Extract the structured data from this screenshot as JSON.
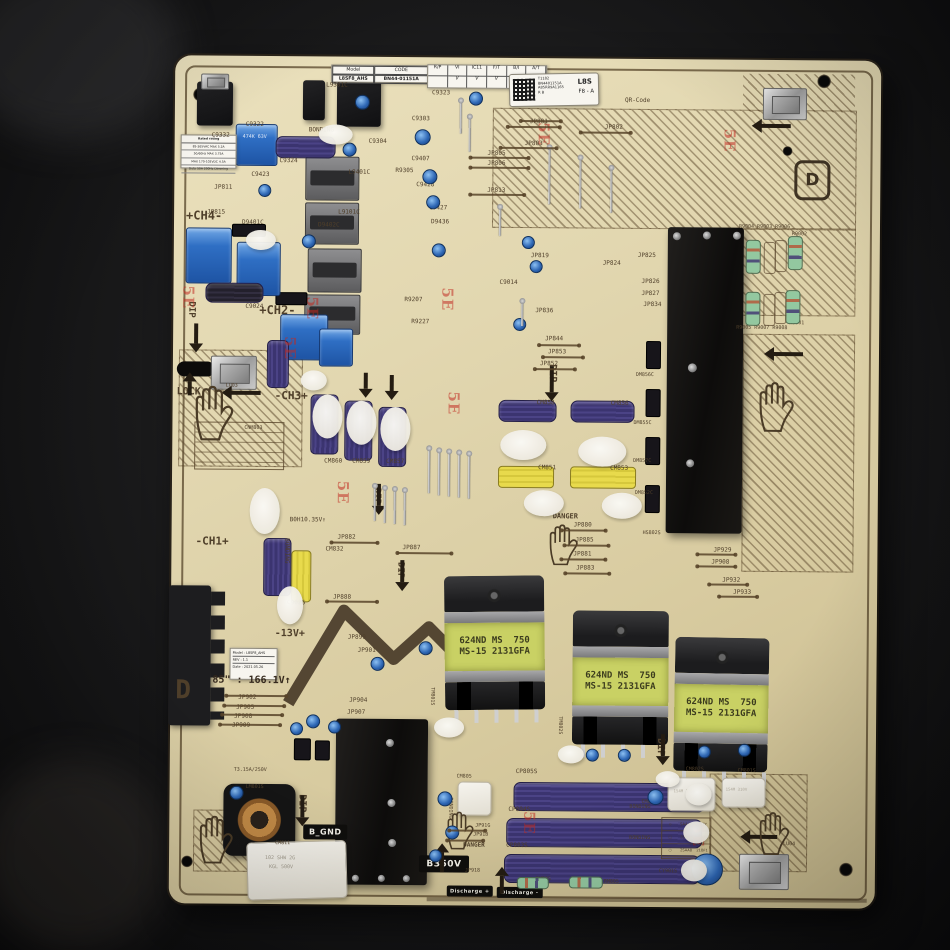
{
  "title": "Samsung power supply board photo",
  "stickers": {
    "model_label": {
      "model_key": "Model",
      "model_value": "L8SF8_AHS",
      "code_key": "CODE",
      "code_value": "BN44-01151A"
    },
    "check_strip": {
      "headers": [
        "R/P",
        "VI",
        "IC11",
        "F/T",
        "B/I",
        "A/T"
      ],
      "checks": [
        "",
        "V",
        "V",
        "V",
        "V",
        "V"
      ]
    },
    "barcode": {
      "line1": "T1182",
      "line2": "BN4401151A",
      "line3": "A85RR9A1165",
      "line4": "R B",
      "big": "L8S",
      "sub": "F8 - A"
    },
    "rev_label": {
      "model": "Model : L8SF8_AHS",
      "rev": "REV : 1.1",
      "date": "Date : 2021.05.26"
    },
    "rating_label": {
      "title": "Rated rating",
      "rows": [
        "85-265VAC  MAX 5.2A",
        "50/60Hz  MAX 3.75A",
        "MAX 170-102VDC 4.5A",
        "Duty 50A 200Hz  Dimming"
      ]
    },
    "legend_table": {
      "rows": [
        [
          "◇",
          "SAAA8",
          "21TY"
        ],
        [
          "□",
          "2SAA8",
          "21ATB"
        ],
        [
          "○",
          "2SAA8",
          "21BF1"
        ]
      ]
    }
  },
  "transformer_label": {
    "line1": "624ND MS  750",
    "line2": "MS-15 2131GFA"
  },
  "badges": {
    "b_gnd": "B_GND",
    "b350v": "B350V",
    "discharge_plus": "Discharge +",
    "discharge_minus": "Discharge -"
  },
  "marks": {
    "letter_d": "D"
  },
  "labels": [
    {
      "t": "C9322",
      "x": 243,
      "y": 124,
      "s": 6
    },
    {
      "t": "C9332",
      "x": 209,
      "y": 135,
      "s": 6
    },
    {
      "t": "BONDING",
      "x": 306,
      "y": 129,
      "s": 6
    },
    {
      "t": "C9323",
      "x": 429,
      "y": 91,
      "s": 6
    },
    {
      "t": "C9303",
      "x": 409,
      "y": 117,
      "s": 6
    },
    {
      "t": "L9301C",
      "x": 323,
      "y": 84,
      "s": 6
    },
    {
      "t": "C9304",
      "x": 366,
      "y": 140,
      "s": 6
    },
    {
      "t": "C9407",
      "x": 409,
      "y": 157,
      "s": 6
    },
    {
      "t": "R9305",
      "x": 393,
      "y": 169,
      "s": 6
    },
    {
      "t": "C9428",
      "x": 414,
      "y": 183,
      "s": 6
    },
    {
      "t": "C9427",
      "x": 427,
      "y": 206,
      "s": 6
    },
    {
      "t": "D9436",
      "x": 429,
      "y": 220,
      "s": 6
    },
    {
      "t": "C9423",
      "x": 249,
      "y": 174,
      "s": 6
    },
    {
      "t": "JP811",
      "x": 212,
      "y": 187,
      "s": 6
    },
    {
      "t": "JP815",
      "x": 205,
      "y": 212,
      "s": 6
    },
    {
      "t": "C9324",
      "x": 277,
      "y": 160,
      "s": 6
    },
    {
      "t": "D9401C",
      "x": 240,
      "y": 222,
      "s": 6
    },
    {
      "t": "L9401C",
      "x": 346,
      "y": 171,
      "s": 6
    },
    {
      "t": "L9101C",
      "x": 336,
      "y": 211,
      "s": 6
    },
    {
      "t": "474K 63V",
      "x": 240,
      "y": 137,
      "s": 5,
      "c": "#dfe9f8"
    },
    {
      "t": "+CH4-",
      "x": 184,
      "y": 212,
      "s": 12,
      "b": 1
    },
    {
      "t": "C9024",
      "x": 244,
      "y": 306,
      "s": 6
    },
    {
      "t": "+CH2-",
      "x": 258,
      "y": 306,
      "s": 12,
      "b": 1
    },
    {
      "t": "R9207",
      "x": 403,
      "y": 298,
      "s": 6
    },
    {
      "t": "R9227",
      "x": 410,
      "y": 320,
      "s": 6
    },
    {
      "t": "D9402C",
      "x": 316,
      "y": 224,
      "s": 6
    },
    {
      "t": "QR-Code",
      "x": 622,
      "y": 97,
      "s": 6
    },
    {
      "t": "JP801",
      "x": 527,
      "y": 119,
      "s": 6
    },
    {
      "t": "JP802",
      "x": 602,
      "y": 124,
      "s": 6
    },
    {
      "t": "JP803",
      "x": 522,
      "y": 141,
      "s": 6
    },
    {
      "t": "JP805",
      "x": 485,
      "y": 151,
      "s": 6
    },
    {
      "t": "JP806",
      "x": 485,
      "y": 161,
      "s": 6
    },
    {
      "t": "JP813",
      "x": 485,
      "y": 188,
      "s": 6
    },
    {
      "t": "JP819",
      "x": 529,
      "y": 253,
      "s": 6
    },
    {
      "t": "JP824",
      "x": 601,
      "y": 260,
      "s": 6
    },
    {
      "t": "C9014",
      "x": 498,
      "y": 280,
      "s": 6
    },
    {
      "t": "JP836",
      "x": 534,
      "y": 308,
      "s": 6
    },
    {
      "t": "JP844",
      "x": 544,
      "y": 336,
      "s": 6
    },
    {
      "t": "JP853",
      "x": 547,
      "y": 349,
      "s": 6
    },
    {
      "t": "JP852",
      "x": 539,
      "y": 361,
      "s": 6
    },
    {
      "t": "JP825",
      "x": 636,
      "y": 252,
      "s": 6
    },
    {
      "t": "JP826",
      "x": 640,
      "y": 278,
      "s": 6
    },
    {
      "t": "JP827",
      "x": 640,
      "y": 290,
      "s": 6
    },
    {
      "t": "JP834",
      "x": 642,
      "y": 301,
      "s": 6
    },
    {
      "t": "R9004 R9003 R9006",
      "x": 737,
      "y": 223,
      "s": 5
    },
    {
      "t": "R9002",
      "x": 790,
      "y": 230,
      "s": 5
    },
    {
      "t": "R9005 R9007 R9008",
      "x": 735,
      "y": 324,
      "s": 5
    },
    {
      "t": "R9001",
      "x": 788,
      "y": 319,
      "s": 5
    },
    {
      "t": "LOCK",
      "x": 176,
      "y": 390,
      "s": 10,
      "b": 1
    },
    {
      "t": "LU03",
      "x": 225,
      "y": 386,
      "s": 5
    },
    {
      "t": "-CH3+",
      "x": 274,
      "y": 392,
      "s": 11,
      "b": 1
    },
    {
      "t": "CNM803",
      "x": 244,
      "y": 428,
      "s": 5
    },
    {
      "t": "CM860",
      "x": 324,
      "y": 460,
      "s": 6
    },
    {
      "t": "CM859",
      "x": 352,
      "y": 460,
      "s": 6
    },
    {
      "t": "CM857",
      "x": 386,
      "y": 460,
      "s": 6
    },
    {
      "t": "CM858",
      "x": 536,
      "y": 400,
      "s": 6
    },
    {
      "t": "CM856",
      "x": 610,
      "y": 400,
      "s": 6
    },
    {
      "t": "CM851",
      "x": 538,
      "y": 465,
      "s": 6
    },
    {
      "t": "CM853",
      "x": 610,
      "y": 465,
      "s": 6
    },
    {
      "t": "DM856C",
      "x": 635,
      "y": 372,
      "s": 5
    },
    {
      "t": "DM855C",
      "x": 633,
      "y": 420,
      "s": 5
    },
    {
      "t": "DM857C",
      "x": 633,
      "y": 458,
      "s": 5
    },
    {
      "t": "DM852C",
      "x": 635,
      "y": 490,
      "s": 5
    },
    {
      "t": "-CH1+",
      "x": 196,
      "y": 538,
      "s": 11,
      "b": 1
    },
    {
      "t": "B0H10.35V↑",
      "x": 290,
      "y": 519,
      "s": 6
    },
    {
      "t": "JP882",
      "x": 338,
      "y": 536,
      "s": 6
    },
    {
      "t": "CM832",
      "x": 326,
      "y": 548,
      "s": 6
    },
    {
      "t": "JP887",
      "x": 403,
      "y": 546,
      "s": 6
    },
    {
      "t": "JP888",
      "x": 334,
      "y": 596,
      "s": 6
    },
    {
      "t": "C9026",
      "x": 288,
      "y": 602,
      "s": 6
    },
    {
      "t": "JP880",
      "x": 574,
      "y": 522,
      "s": 6
    },
    {
      "t": "JP885",
      "x": 576,
      "y": 537,
      "s": 6
    },
    {
      "t": "JP881",
      "x": 574,
      "y": 551,
      "s": 6
    },
    {
      "t": "JP883",
      "x": 577,
      "y": 565,
      "s": 6
    },
    {
      "t": "DANGER",
      "x": 553,
      "y": 513,
      "s": 7,
      "b": 1
    },
    {
      "t": "HS802S",
      "x": 643,
      "y": 530,
      "s": 5
    },
    {
      "t": "JP929",
      "x": 714,
      "y": 546,
      "s": 6
    },
    {
      "t": "JP908",
      "x": 712,
      "y": 558,
      "s": 6
    },
    {
      "t": "JP932",
      "x": 723,
      "y": 576,
      "s": 6
    },
    {
      "t": "JP933",
      "x": 734,
      "y": 588,
      "s": 6
    },
    {
      "t": "BONDING",
      "x": 290,
      "y": 540,
      "s": 6,
      "r": 90
    },
    {
      "t": "-13V+",
      "x": 276,
      "y": 631,
      "s": 10,
      "b": 1
    },
    {
      "t": "85\" : 166.1V↑",
      "x": 214,
      "y": 678,
      "s": 10,
      "b": 1,
      "c": "#35291d"
    },
    {
      "t": "D",
      "x": 177,
      "y": 680,
      "s": 26,
      "b": 1
    },
    {
      "t": "JP902",
      "x": 240,
      "y": 697,
      "s": 6
    },
    {
      "t": "JP905",
      "x": 238,
      "y": 707,
      "s": 6
    },
    {
      "t": "JP908",
      "x": 236,
      "y": 716,
      "s": 6
    },
    {
      "t": "JP909",
      "x": 234,
      "y": 725,
      "s": 6
    },
    {
      "t": "JP899",
      "x": 349,
      "y": 636,
      "s": 6
    },
    {
      "t": "JP901",
      "x": 359,
      "y": 649,
      "s": 6
    },
    {
      "t": "JP904",
      "x": 351,
      "y": 699,
      "s": 6
    },
    {
      "t": "JP907",
      "x": 349,
      "y": 711,
      "s": 6
    },
    {
      "t": "TM801S",
      "x": 436,
      "y": 688,
      "s": 5,
      "r": 90
    },
    {
      "t": "TM802S",
      "x": 564,
      "y": 716,
      "s": 5,
      "r": 90
    },
    {
      "t": "TM803S",
      "x": 666,
      "y": 736,
      "s": 5,
      "r": 90
    },
    {
      "t": "DIP",
      "x": 194,
      "y": 304,
      "s": 9,
      "b": 1,
      "r": 90
    },
    {
      "t": "DIP",
      "x": 556,
      "y": 364,
      "s": 10,
      "b": 1,
      "r": 90
    },
    {
      "t": "DIP",
      "x": 381,
      "y": 489,
      "s": 9,
      "b": 1,
      "r": 90
    },
    {
      "t": "DIP",
      "x": 405,
      "y": 563,
      "s": 9,
      "b": 1,
      "r": 90
    },
    {
      "t": "DIP",
      "x": 309,
      "y": 796,
      "s": 10,
      "b": 1,
      "r": 90
    },
    {
      "t": "DIP",
      "x": 667,
      "y": 737,
      "s": 10,
      "b": 1,
      "r": 90
    },
    {
      "t": "T3.15A/250V",
      "x": 236,
      "y": 770,
      "s": 5
    },
    {
      "t": "LM801S",
      "x": 248,
      "y": 787,
      "s": 5
    },
    {
      "t": "CM811",
      "x": 278,
      "y": 843,
      "s": 5
    },
    {
      "t": "102 SHW 2G",
      "x": 268,
      "y": 858,
      "s": 5,
      "c": "#a29c8e"
    },
    {
      "t": "KGL 500V",
      "x": 272,
      "y": 867,
      "s": 5,
      "c": "#a29c8e"
    },
    {
      "t": "CM805",
      "x": 459,
      "y": 775,
      "s": 5
    },
    {
      "t": "BONDING",
      "x": 455,
      "y": 798,
      "s": 5,
      "r": 90
    },
    {
      "t": "CP805S",
      "x": 518,
      "y": 769,
      "s": 6
    },
    {
      "t": "CP804S",
      "x": 511,
      "y": 807,
      "s": 6
    },
    {
      "t": "CP803S",
      "x": 509,
      "y": 843,
      "s": 6
    },
    {
      "t": "JP91G",
      "x": 478,
      "y": 824,
      "s": 5
    },
    {
      "t": "JP91B",
      "x": 476,
      "y": 833,
      "s": 5
    },
    {
      "t": "JP918",
      "x": 468,
      "y": 869,
      "s": 5
    },
    {
      "t": "DANGER",
      "x": 466,
      "y": 843,
      "s": 6,
      "b": 1
    },
    {
      "t": "RM805",
      "x": 539,
      "y": 877,
      "s": 5
    },
    {
      "t": "RM805",
      "x": 607,
      "y": 879,
      "s": 5
    },
    {
      "t": "CM802",
      "x": 644,
      "y": 799,
      "s": 5
    },
    {
      "t": "CM802S",
      "x": 688,
      "y": 766,
      "s": 5
    },
    {
      "t": "CM801S",
      "x": 740,
      "y": 767,
      "s": 5
    },
    {
      "t": "154M 310V",
      "x": 676,
      "y": 788,
      "s": 4,
      "c": "#b8b2a4"
    },
    {
      "t": "154M 310V",
      "x": 728,
      "y": 786,
      "s": 4,
      "c": "#b8b2a4"
    },
    {
      "t": "CY901S",
      "x": 662,
      "y": 868,
      "s": 5
    },
    {
      "t": "LU04",
      "x": 786,
      "y": 840,
      "s": 5
    },
    {
      "t": "BONDING",
      "x": 632,
      "y": 804,
      "s": 5
    },
    {
      "t": "BONDING",
      "x": 632,
      "y": 835,
      "s": 5
    }
  ],
  "decor": {
    "arrows": [
      [
        "down",
        546,
        366,
        26
      ],
      [
        "down",
        374,
        485,
        22
      ],
      [
        "down",
        398,
        561,
        22
      ],
      [
        "down",
        300,
        797,
        22
      ],
      [
        "down",
        660,
        733,
        22
      ],
      [
        "down",
        190,
        326,
        20
      ],
      [
        "left",
        222,
        390,
        30
      ],
      [
        "left",
        750,
        119,
        30
      ],
      [
        "left",
        764,
        347,
        30
      ],
      [
        "left",
        744,
        830,
        28
      ],
      [
        "down",
        360,
        374,
        16
      ],
      [
        "down",
        386,
        376,
        16
      ],
      [
        "up",
        440,
        843,
        20
      ],
      [
        "up",
        500,
        866,
        18
      ],
      [
        "up",
        184,
        374,
        14
      ]
    ],
    "hands": [
      [
        192,
        388,
        46
      ],
      [
        548,
        524,
        34
      ],
      [
        448,
        812,
        32
      ],
      [
        200,
        818,
        40
      ],
      [
        760,
        810,
        36
      ],
      [
        756,
        380,
        42
      ]
    ],
    "stamps": [
      [
        196,
        288
      ],
      [
        320,
        298
      ],
      [
        455,
        288
      ],
      [
        462,
        392
      ],
      [
        550,
        122
      ],
      [
        736,
        127
      ],
      [
        541,
        811
      ],
      [
        710,
        822
      ],
      [
        352,
        482
      ],
      [
        298,
        338
      ]
    ],
    "blue_dots": [
      [
        352,
        96,
        13
      ],
      [
        340,
        144,
        12
      ],
      [
        412,
        130,
        14
      ],
      [
        420,
        170,
        13
      ],
      [
        424,
        196,
        12
      ],
      [
        300,
        236,
        12
      ],
      [
        256,
        186,
        11
      ],
      [
        430,
        244,
        12
      ],
      [
        520,
        236,
        11
      ],
      [
        528,
        260,
        11
      ],
      [
        512,
        318,
        11
      ],
      [
        372,
        658,
        12
      ],
      [
        420,
        642,
        12
      ],
      [
        308,
        716,
        12
      ],
      [
        292,
        724,
        11
      ],
      [
        330,
        722,
        11
      ],
      [
        440,
        792,
        13
      ],
      [
        448,
        826,
        12
      ],
      [
        432,
        850,
        11
      ],
      [
        650,
        788,
        14
      ],
      [
        588,
        748,
        11
      ],
      [
        620,
        748,
        11
      ],
      [
        700,
        744,
        11
      ],
      [
        740,
        742,
        11
      ],
      [
        232,
        788,
        12
      ],
      [
        694,
        852,
        30
      ],
      [
        466,
        92,
        12
      ]
    ],
    "glue": [
      [
        312,
        396,
        30,
        44
      ],
      [
        346,
        402,
        30,
        44
      ],
      [
        380,
        408,
        30,
        44
      ],
      [
        300,
        372,
        26,
        20
      ],
      [
        250,
        490,
        30,
        46
      ],
      [
        278,
        588,
        26,
        38
      ],
      [
        500,
        430,
        46,
        30
      ],
      [
        578,
        436,
        48,
        30
      ],
      [
        524,
        490,
        40,
        26
      ],
      [
        602,
        492,
        40,
        26
      ],
      [
        244,
        232,
        30,
        20
      ],
      [
        316,
        126,
        34,
        20
      ],
      [
        688,
        782,
        26,
        22
      ],
      [
        686,
        820,
        26,
        22
      ],
      [
        684,
        858,
        26,
        22
      ],
      [
        436,
        718,
        30,
        20
      ],
      [
        560,
        745,
        26,
        18
      ],
      [
        658,
        770,
        24,
        16
      ]
    ],
    "pins": [
      [
        428,
        448,
        46
      ],
      [
        438,
        450,
        46
      ],
      [
        448,
        451,
        46
      ],
      [
        458,
        452,
        46
      ],
      [
        468,
        453,
        46
      ],
      [
        374,
        486,
        36
      ],
      [
        384,
        488,
        36
      ],
      [
        394,
        489,
        36
      ],
      [
        404,
        490,
        36
      ],
      [
        546,
        146,
        58
      ],
      [
        577,
        156,
        52
      ],
      [
        608,
        166,
        46
      ],
      [
        466,
        116,
        36
      ],
      [
        497,
        206,
        30
      ],
      [
        520,
        300,
        26
      ],
      [
        457,
        100,
        34
      ]
    ],
    "lines": [
      [
        505,
        126,
        52
      ],
      [
        578,
        131,
        50
      ],
      [
        498,
        147,
        56
      ],
      [
        468,
        157,
        58
      ],
      [
        468,
        167,
        58
      ],
      [
        468,
        194,
        54
      ],
      [
        538,
        344,
        40
      ],
      [
        542,
        356,
        40
      ],
      [
        534,
        368,
        40
      ],
      [
        562,
        529,
        44
      ],
      [
        565,
        544,
        44
      ],
      [
        562,
        558,
        44
      ],
      [
        566,
        572,
        44
      ],
      [
        698,
        552,
        38
      ],
      [
        698,
        564,
        38
      ],
      [
        710,
        582,
        38
      ],
      [
        720,
        594,
        38
      ],
      [
        452,
        830,
        36
      ],
      [
        450,
        840,
        36
      ],
      [
        228,
        697,
        60
      ],
      [
        226,
        707,
        60
      ],
      [
        224,
        716,
        60
      ],
      [
        222,
        726,
        60
      ],
      [
        332,
        543,
        46
      ],
      [
        398,
        553,
        54
      ],
      [
        328,
        602,
        50
      ],
      [
        518,
        120,
        40
      ]
    ],
    "greens": [
      [
        744,
        238,
        13,
        32,
        0
      ],
      [
        786,
        234,
        13,
        32,
        0
      ],
      [
        744,
        290,
        13,
        32,
        0
      ],
      [
        784,
        288,
        13,
        32,
        0
      ],
      [
        520,
        877,
        30,
        10,
        1
      ],
      [
        572,
        876,
        32,
        10,
        1
      ]
    ],
    "ores": [
      [
        762,
        240,
        10,
        30
      ],
      [
        773,
        238,
        10,
        30
      ],
      [
        762,
        292,
        10,
        30
      ],
      [
        773,
        290,
        10,
        30
      ]
    ]
  }
}
